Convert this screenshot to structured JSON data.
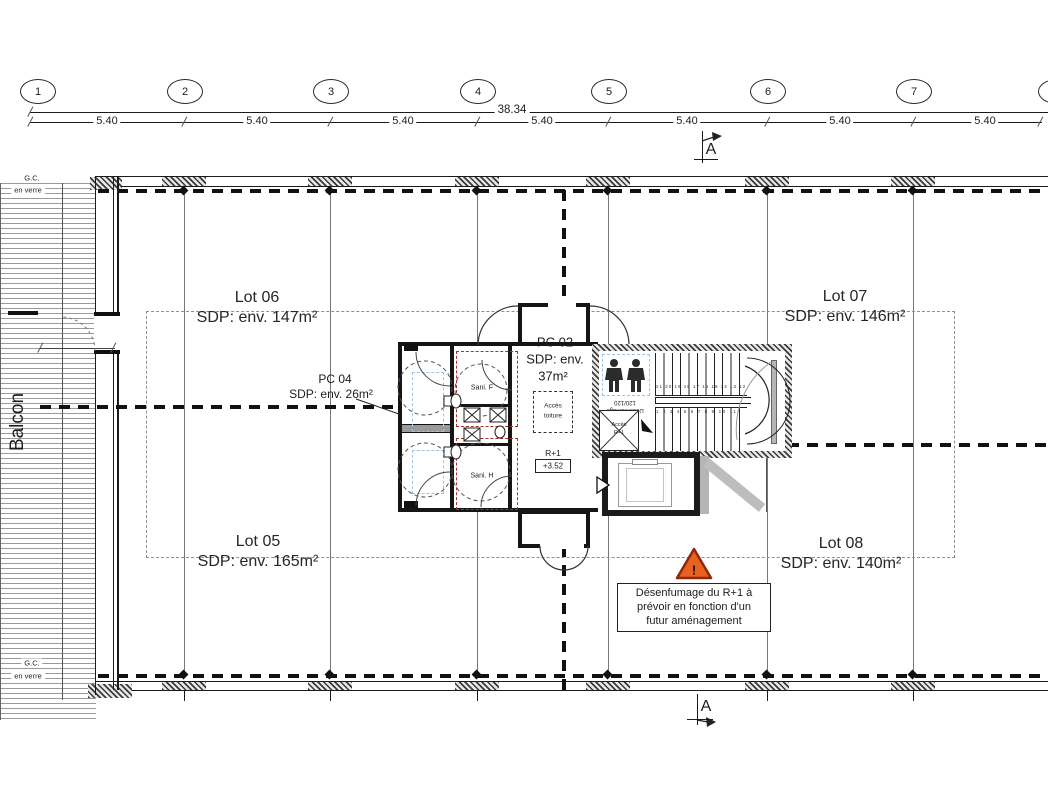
{
  "colors": {
    "line": "#1a1a1a",
    "red_dashed": "#a93226",
    "blue_dashed": "#9dc3e6",
    "warning_fill": "#e8611f",
    "warning_border": "#8c2a10",
    "lot_boundary_gray": "#8f8f8f"
  },
  "grid": {
    "bubbles": [
      "1",
      "2",
      "3",
      "4",
      "5",
      "6",
      "7",
      "8"
    ],
    "total_dim": "38.34",
    "segment_dims": [
      "5.40",
      "5.40",
      "5.40",
      "5.40",
      "5.40",
      "5.40",
      "5.40"
    ]
  },
  "section_marker": {
    "top": "A",
    "bottom": "A"
  },
  "lots": {
    "lot06": {
      "name": "Lot 06",
      "area": "SDP: env. 147m²"
    },
    "lot07": {
      "name": "Lot 07",
      "area": "SDP: env. 146m²"
    },
    "lot05": {
      "name": "Lot 05",
      "area": "SDP: env. 165m²"
    },
    "lot08": {
      "name": "Lot 08",
      "area": "SDP: env. 140m²"
    }
  },
  "pc02": {
    "name": "PC 02",
    "line2": "SDP: env.",
    "line3": "37m²"
  },
  "pc04": {
    "name": "PC 04",
    "area": "SDP: env. 26m²"
  },
  "core": {
    "sani_f": "Sani. F",
    "sani_h": "Sani. H",
    "acces_line1": "Accès",
    "acces_line2": "toiture",
    "level": "R+1",
    "elevation": "+3.52"
  },
  "stairs": {
    "mirror_line1": "Désenfumage",
    "mirror_line2": "120/120",
    "acces_line1": "Accès",
    "acces_line2": "R+1",
    "upper_numbers": "21 20 19 18 17 16 15 14 13 12",
    "lower_numbers": "1 2 3 4 5 6 7 8 9 10 11"
  },
  "balcony": {
    "label": "Balcon",
    "gc_top": "G.C.",
    "verre_top": "en verre",
    "gc_bottom": "G.C.",
    "verre_bottom": "en verre"
  },
  "warning": {
    "icon_char": "!",
    "line1": "Désenfumage du R+1 à",
    "line2": "prévoir en fonction d'un",
    "line3": "futur aménagement"
  }
}
